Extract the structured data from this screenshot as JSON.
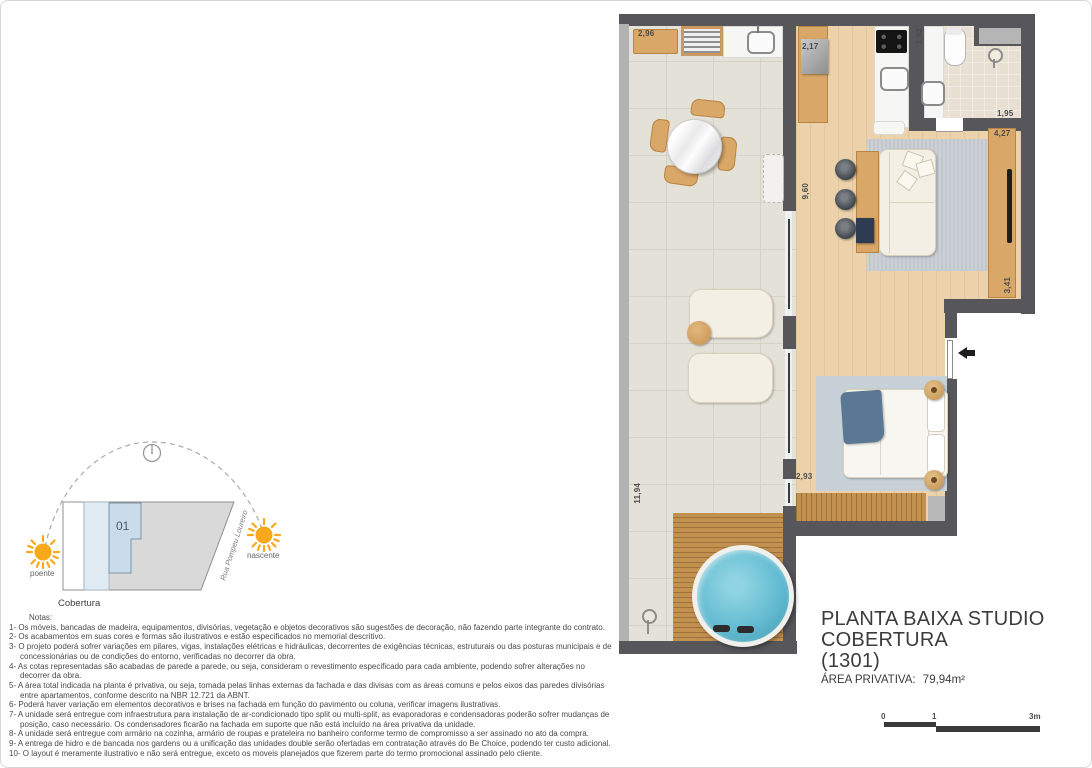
{
  "title_block": {
    "title": "PLANTA BAIXA STUDIO COBERTURA",
    "unit": "(1301)",
    "area_label": "ÁREA PRIVATIVA:",
    "area_value": "79,94m²"
  },
  "key_plan": {
    "unit_number": "01",
    "floor_label": "Cobertura",
    "street": "Rua Pompeu Loureiro",
    "sun_west_label": "poente",
    "sun_east_label": "nascente"
  },
  "scale_bar": {
    "start": "0",
    "mid": "1",
    "end": "3m"
  },
  "dimensions": {
    "outdoor_bench": "2,96",
    "kitchen_cabinet": "2,17",
    "bath_width": "1,82",
    "bath_length": "1,95",
    "living_width": "4,27",
    "living_length": "9,60",
    "sideboard": "3,41",
    "bedroom": "2,93",
    "terrace_length": "11,94"
  },
  "notes": {
    "heading": "Notas:",
    "items": [
      "1- Os móveis, bancadas de madeira, equipamentos, divisórias, vegetação e objetos decorativos são sugestões de decoração, não fazendo parte integrante do contrato.",
      "2- Os acabamentos em suas cores e formas são ilustrativos e estão especificados no memorial descritivo.",
      "3- O projeto poderá sofrer variações em pilares, vigas, instalações elétricas e hidráulicas, decorrentes de exigências técnicas, estruturais ou das posturas municipais e de concessionárias ou de condições do entorno, verificadas no decorrer da obra.",
      "4- As cotas representadas são acabadas de parede a parede, ou seja, consideram o revestimento especificado para cada ambiente, podendo sofrer alterações no decorrer da obra.",
      "5- A área total indicada na planta é privativa, ou seja, tomada pelas linhas externas da fachada e das divisas com as áreas comuns e pelos eixos das paredes divisórias entre apartamentos, conforme descrito na NBR 12.721 da ABNT.",
      "6- Poderá haver variação em elementos decorativos e brises na fachada em função do pavimento ou coluna, verificar imagens ilustrativas.",
      "7- A unidade será entregue com infraestrutura para instalação de ar-condicionado tipo split ou multi-split, as evaporadoras e condensadoras poderão sofrer mudanças de posição, caso necessário. Os condensadores ficarão na fachada em suporte que não está incluído na área privativa da unidade.",
      "8- A unidade será entregue com armário na cozinha, armário de roupas e prateleira no banheiro conforme termo de compromisso a ser assinado no ato da compra.",
      "9- A entrega de hidro e de bancada nos gardens ou a unificação das unidades double serão ofertadas em contratação através do Be Choice, podendo ter custo adicional.",
      "10- O layout é meramente ilustrativo e não será entregue, exceto os moveis planejados que fizerem parte do termo promocional assinado pelo cliente."
    ]
  },
  "colors": {
    "wall": "#57565a",
    "terrace_floor": "#e4e1d8",
    "wood_floor": "#ebd2ab",
    "deck": "#c3914f",
    "rug": "#c1c7cc",
    "water": "#64bcd2",
    "sun": "#f7a81b",
    "unit_highlight": "#c9dcec"
  }
}
